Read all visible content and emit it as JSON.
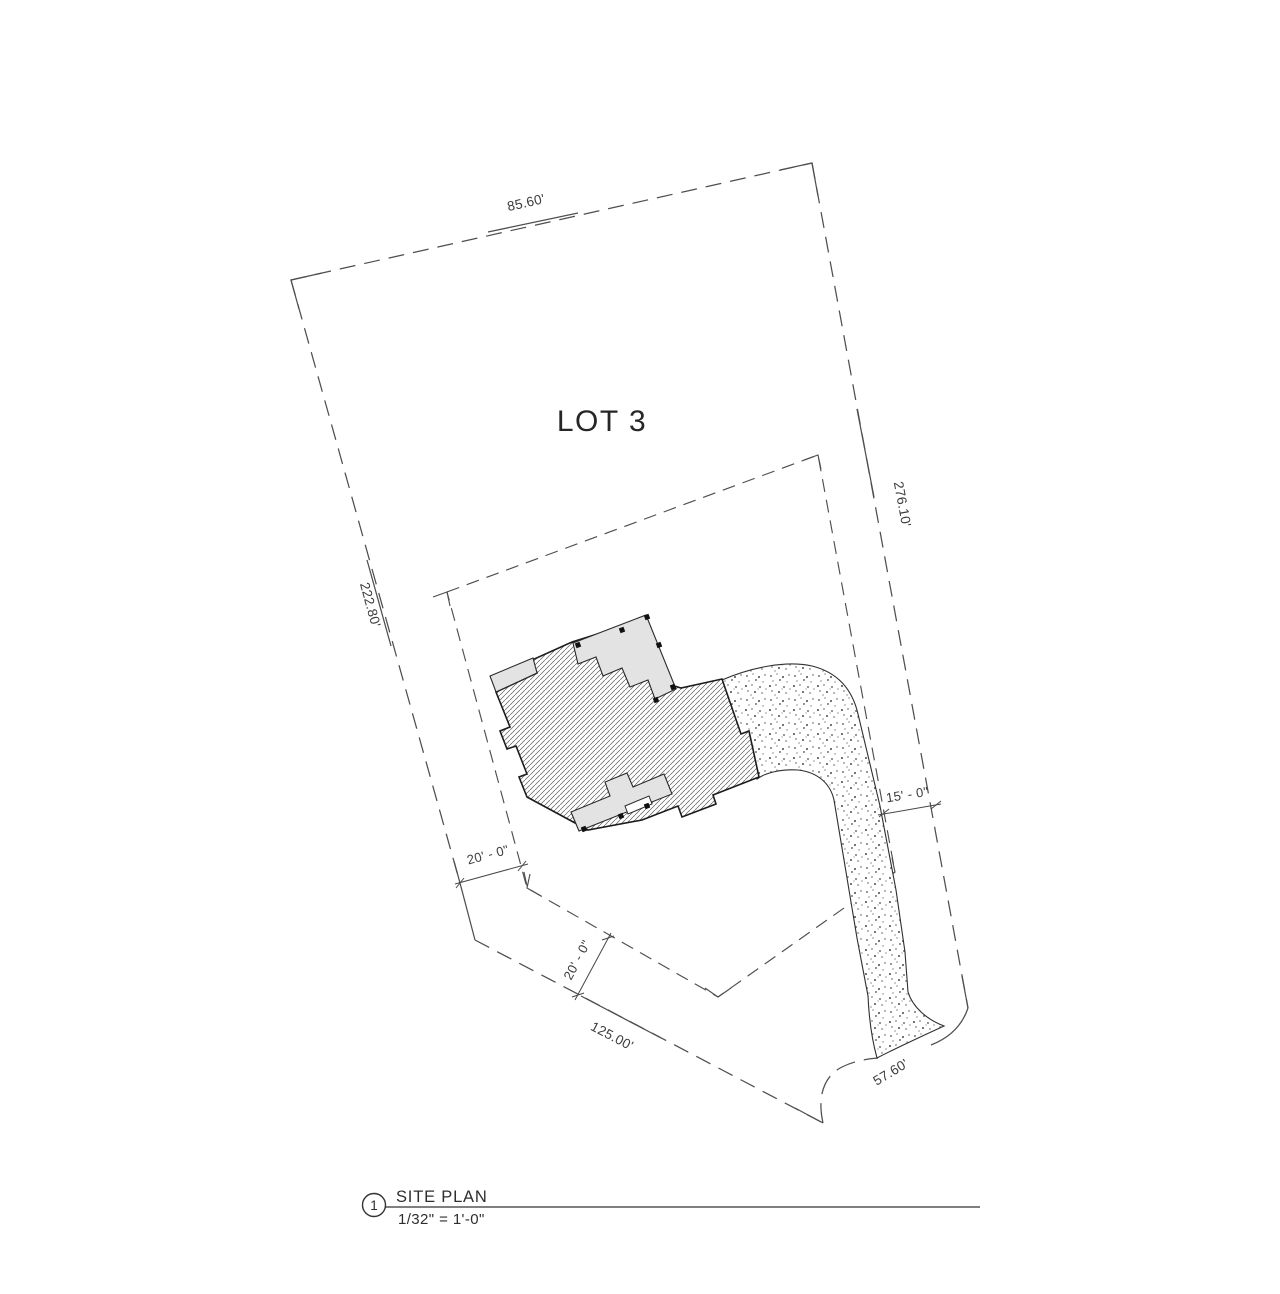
{
  "drawing": {
    "lot_label": "LOT 3",
    "boundary": {
      "top_dim": "85.60'",
      "right_dim": "276.10'",
      "left_dim": "222.80'",
      "bottom_dim": "125.00'",
      "frontage_dim": "57.60'"
    },
    "setbacks": {
      "left_dim": "20' - 0\"",
      "bottom_dim": "20' - 0\"",
      "right_dim": "15' - 0\""
    },
    "title_block": {
      "detail_number": "1",
      "title": "SITE PLAN",
      "scale": "1/32\" = 1'-0\""
    },
    "colors": {
      "boundary_line": "#4f4f4f",
      "building_outline": "#1c1c1c",
      "deck_fill": "#e3e3e3",
      "hatch_stroke": "#5f5f5f"
    }
  }
}
